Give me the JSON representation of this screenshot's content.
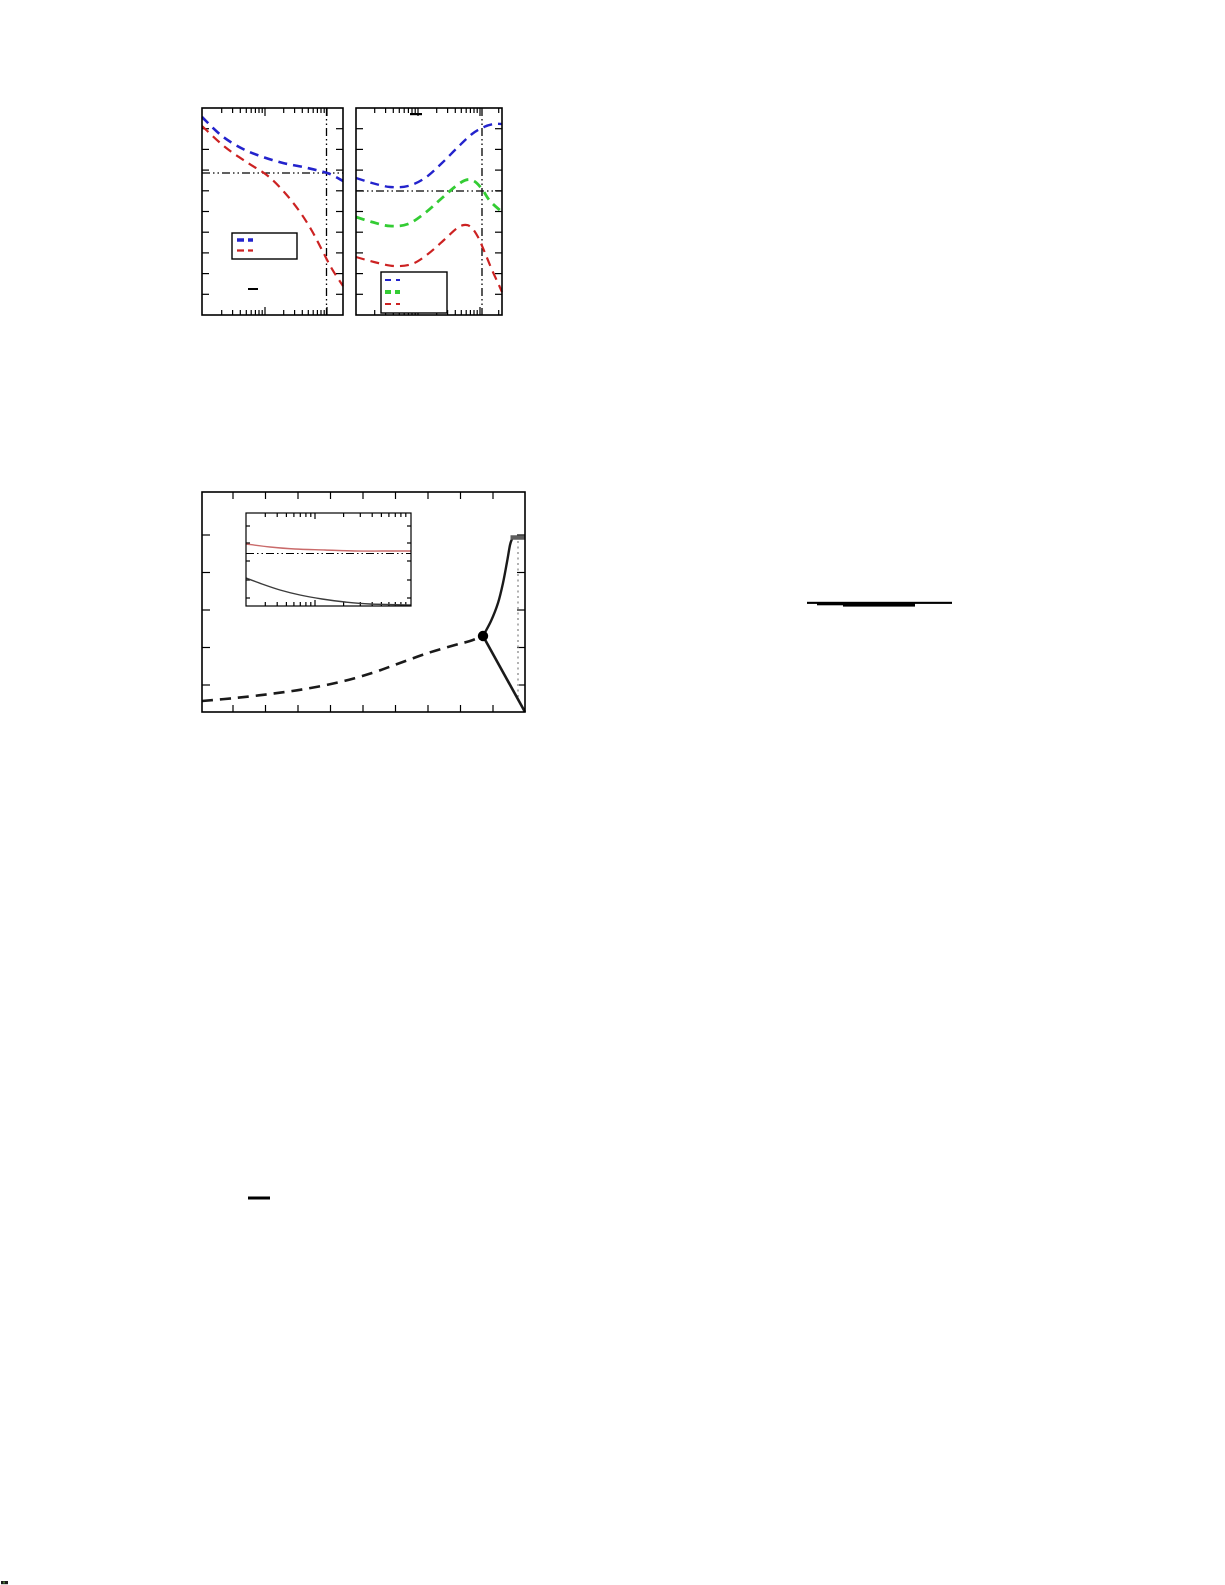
{
  "canvas": {
    "width": 1225,
    "height": 1585,
    "background": "#ffffff"
  },
  "colors": {
    "blue": "#2323cc",
    "red": "#cc2222",
    "green": "#33cc33",
    "black": "#000000",
    "near_black": "#1a1a1a",
    "gray": "#b2b2b2",
    "plateau": "#5e5e5e",
    "inset_red": "#c96a6a",
    "inset_black": "#3c3c3c"
  },
  "chart_data": [
    {
      "id": "top-left",
      "type": "line",
      "title": "",
      "xlabel": "",
      "ylabel": "",
      "x_scale": "log",
      "y_scale": "linear",
      "axis_text_rendered": false,
      "frame": {
        "x": 202,
        "y": 108,
        "w": 141,
        "h": 207
      },
      "ticks": [
        {
          "edge": "bottom",
          "len": 5,
          "pos": [
            221.7,
            232.6,
            240.3,
            246.3,
            251.2,
            255.4,
            259,
            262.2,
            283.7,
            294.6,
            302.3,
            308.3,
            313.2,
            317.4,
            321,
            324.2
          ]
        },
        {
          "edge": "bottom",
          "len": 8,
          "pos": [
            265,
            327
          ]
        },
        {
          "edge": "top",
          "len": 5,
          "pos": [
            221.7,
            232.6,
            240.3,
            246.3,
            251.2,
            255.4,
            259,
            262.2,
            283.7,
            294.6,
            302.3,
            308.3,
            313.2,
            317.4,
            321,
            324.2
          ]
        },
        {
          "edge": "top",
          "len": 8,
          "pos": [
            265,
            327
          ]
        },
        {
          "edge": "left",
          "len": 7,
          "pos": [
            128.7,
            149.4,
            170.1,
            190.8,
            211.5,
            232.2,
            252.9,
            273.6,
            294.3
          ]
        },
        {
          "edge": "right",
          "len": 7,
          "pos": [
            128.7,
            149.4,
            170.1,
            190.8,
            211.5,
            232.2,
            252.9,
            273.6,
            294.3
          ]
        }
      ],
      "ref_lines": [
        {
          "orient": "h",
          "at": 173,
          "from": 202,
          "to": 343,
          "style": "dashdotdot",
          "color": "black",
          "w": 1.3
        },
        {
          "orient": "v",
          "at": 326.5,
          "from": 108,
          "to": 315,
          "style": "dashdotdot",
          "color": "black",
          "w": 1.3
        }
      ],
      "series": [
        {
          "name": "blue-dashed",
          "color": "blue",
          "w": 2.6,
          "dash": "9 6",
          "smooth": true,
          "pts": [
            [
              202,
              117
            ],
            [
              222,
              136
            ],
            [
              243,
              149
            ],
            [
              263,
              157
            ],
            [
              283,
              163
            ],
            [
              303,
              167
            ],
            [
              320,
              171
            ],
            [
              330,
              174
            ],
            [
              343,
              181
            ]
          ]
        },
        {
          "name": "red-dashed",
          "color": "red",
          "w": 2.2,
          "dash": "9 6",
          "smooth": true,
          "pts": [
            [
              202,
              126
            ],
            [
              225,
              147
            ],
            [
              248,
              163
            ],
            [
              268,
              176
            ],
            [
              285,
              193
            ],
            [
              300,
              212
            ],
            [
              312,
              231
            ],
            [
              322,
              250
            ],
            [
              332,
              269
            ],
            [
              343,
              286
            ]
          ]
        }
      ],
      "legend": {
        "box": {
          "x": 232,
          "y": 233,
          "w": 65,
          "h": 26
        },
        "sample_x1": 237,
        "sample_x2": 253,
        "entries": [
          {
            "label": "",
            "color": "blue",
            "w": 3.6,
            "dash": "7 4",
            "y": 240
          },
          {
            "label": "",
            "color": "red",
            "w": 2.2,
            "dash": "7 4",
            "y": 250.5
          }
        ]
      },
      "marks": [
        {
          "type": "bar",
          "x": 248,
          "y": 288,
          "w": 10,
          "h": 2,
          "color": "black"
        }
      ]
    },
    {
      "id": "top-right",
      "type": "line",
      "title": "",
      "xlabel": "",
      "ylabel": "",
      "x_scale": "log",
      "y_scale": "linear",
      "axis_text_rendered": false,
      "frame": {
        "x": 356,
        "y": 108,
        "w": 146,
        "h": 207
      },
      "ticks": [
        {
          "edge": "bottom",
          "len": 5,
          "pos": [
            374.7,
            385.6,
            393.3,
            399.3,
            404.2,
            408.4,
            412,
            415.2,
            436.7,
            447.6,
            455.3,
            461.3,
            466.2,
            470.4,
            474,
            477.2,
            498.7
          ]
        },
        {
          "edge": "bottom",
          "len": 8,
          "pos": [
            418,
            480
          ]
        },
        {
          "edge": "top",
          "len": 5,
          "pos": [
            374.7,
            385.6,
            393.3,
            399.3,
            404.2,
            408.4,
            412,
            415.2,
            436.7,
            447.6,
            455.3,
            461.3,
            466.2,
            470.4,
            474,
            477.2,
            498.7
          ]
        },
        {
          "edge": "top",
          "len": 8,
          "pos": [
            418,
            480
          ]
        },
        {
          "edge": "left",
          "len": 7,
          "pos": [
            128.7,
            149.4,
            170.1,
            190.8,
            211.5,
            232.2,
            252.9,
            273.6,
            294.3
          ]
        },
        {
          "edge": "right",
          "len": 7,
          "pos": [
            128.7,
            149.4,
            170.1,
            190.8,
            211.5,
            232.2,
            252.9,
            273.6,
            294.3
          ]
        }
      ],
      "ref_lines": [
        {
          "orient": "h",
          "at": 191,
          "from": 356,
          "to": 502,
          "style": "dashdotdot",
          "color": "black",
          "w": 1.3
        },
        {
          "orient": "v",
          "at": 482,
          "from": 108,
          "to": 315,
          "style": "dashdotdot",
          "color": "black",
          "w": 1.3
        }
      ],
      "series": [
        {
          "name": "blue-dashed",
          "color": "blue",
          "w": 2.4,
          "dash": "9 6",
          "smooth": true,
          "pts": [
            [
              356,
              178
            ],
            [
              372,
              183
            ],
            [
              390,
              187
            ],
            [
              408,
              186
            ],
            [
              425,
              178
            ],
            [
              442,
              163
            ],
            [
              458,
              147
            ],
            [
              472,
              134
            ],
            [
              484,
              127
            ],
            [
              494,
              124
            ],
            [
              502,
              124
            ]
          ]
        },
        {
          "name": "green-dashed",
          "color": "green",
          "w": 2.8,
          "dash": "9 6",
          "smooth": true,
          "pts": [
            [
              356,
              217
            ],
            [
              372,
              222
            ],
            [
              390,
              226
            ],
            [
              408,
              224
            ],
            [
              425,
              213
            ],
            [
              442,
              198
            ],
            [
              456,
              186
            ],
            [
              466,
              180
            ],
            [
              474,
              181
            ],
            [
              482,
              189
            ],
            [
              490,
              201
            ],
            [
              502,
              212
            ]
          ]
        },
        {
          "name": "red-dashed",
          "color": "red",
          "w": 2.2,
          "dash": "9 6",
          "smooth": true,
          "pts": [
            [
              356,
              257
            ],
            [
              374,
              262
            ],
            [
              394,
              266
            ],
            [
              412,
              264
            ],
            [
              428,
              254
            ],
            [
              444,
              240
            ],
            [
              456,
              229
            ],
            [
              464,
              225
            ],
            [
              471,
              227
            ],
            [
              478,
              237
            ],
            [
              485,
              253
            ],
            [
              492,
              270
            ],
            [
              498,
              283
            ],
            [
              502,
              292
            ]
          ]
        }
      ],
      "legend": {
        "box": {
          "x": 381,
          "y": 272,
          "w": 66,
          "h": 41
        },
        "sample_x1": 385,
        "sample_x2": 400,
        "entries": [
          {
            "label": "",
            "color": "blue",
            "w": 2.0,
            "dash": "6 5",
            "y": 280
          },
          {
            "label": "",
            "color": "green",
            "w": 4.0,
            "dash": "6 4",
            "y": 292
          },
          {
            "label": "",
            "color": "red",
            "w": 2.0,
            "dash": "6 5",
            "y": 304
          }
        ]
      },
      "marks": [
        {
          "type": "bar",
          "x": 410,
          "y": 113,
          "w": 12,
          "h": 2.2,
          "color": "black"
        }
      ]
    },
    {
      "id": "main",
      "type": "line",
      "title": "",
      "xlabel": "",
      "ylabel": "",
      "x_scale": "linear",
      "y_scale": "linear",
      "axis_text_rendered": false,
      "frame": {
        "x": 202,
        "y": 492,
        "w": 323,
        "h": 220
      },
      "ticks": [
        {
          "edge": "bottom",
          "len": 7,
          "pos": [
            233,
            265.5,
            298,
            330.5,
            363,
            395.5,
            428,
            460.5,
            493
          ]
        },
        {
          "edge": "top",
          "len": 7,
          "pos": [
            233,
            265.5,
            298,
            330.5,
            363,
            395.5,
            428,
            460.5,
            493
          ]
        },
        {
          "edge": "left",
          "len": 8,
          "pos": [
            535,
            572.5,
            610,
            647.5,
            685
          ]
        },
        {
          "edge": "right",
          "len": 8,
          "pos": [
            535,
            572.5,
            610,
            647.5,
            685
          ]
        }
      ],
      "ref_lines": [
        {
          "orient": "v",
          "at": 518,
          "from": 541,
          "to": 700,
          "style": "dotted",
          "color": "gray",
          "w": 2
        }
      ],
      "series": [
        {
          "name": "lower-branch-dashed",
          "color": "near_black",
          "w": 2.6,
          "dash": "11 7",
          "smooth": true,
          "pts": [
            [
              202,
              701
            ],
            [
              235,
              698
            ],
            [
              270,
              694
            ],
            [
              305,
              689
            ],
            [
              340,
              682
            ],
            [
              372,
              673
            ],
            [
              400,
              663
            ],
            [
              428,
              653
            ],
            [
              455,
              645
            ],
            [
              470,
              641
            ],
            [
              483,
              636
            ]
          ]
        },
        {
          "name": "upper-branch-solid",
          "color": "near_black",
          "w": 2.4,
          "smooth": true,
          "pts": [
            [
              483,
              636
            ],
            [
              491,
              621
            ],
            [
              498,
              603
            ],
            [
              503,
              583
            ],
            [
              507,
              562
            ],
            [
              510,
              545
            ],
            [
              512,
              539
            ]
          ]
        },
        {
          "name": "plateau-segment",
          "color": "plateau",
          "w": 4.5,
          "pts": [
            [
              510.5,
              537.5
            ],
            [
              525,
              537.5
            ]
          ]
        },
        {
          "name": "descending-branch-solid",
          "color": "near_black",
          "w": 2.6,
          "pts": [
            [
              483,
              636
            ],
            [
              525,
              712
            ]
          ]
        }
      ],
      "marks": [
        {
          "type": "dot",
          "cx": 483,
          "cy": 636,
          "r": 5.2
        }
      ],
      "children": [
        {
          "id": "main-inset",
          "type": "line",
          "x_scale": "log",
          "y_scale": "linear",
          "axis_text_rendered": false,
          "frame": {
            "x": 246,
            "y": 513,
            "w": 165,
            "h": 93
          },
          "frame_w": 1.2,
          "ticks": [
            {
              "edge": "bottom",
              "len": 4,
              "pos": [
                265.3,
                277.2,
                286.4,
                293.9,
                300.3,
                305.9,
                310.8,
                343.6,
                360.3,
                372.2,
                381.4,
                388.9,
                395.3,
                400.9,
                405.8
              ]
            },
            {
              "edge": "bottom",
              "len": 6,
              "pos": [
                315
              ]
            },
            {
              "edge": "top",
              "len": 4,
              "pos": [
                265.3,
                277.2,
                286.4,
                293.9,
                300.3,
                305.9,
                310.8,
                343.6,
                360.3,
                372.2,
                381.4,
                388.9,
                395.3,
                400.9,
                405.8
              ]
            },
            {
              "edge": "top",
              "len": 6,
              "pos": [
                315
              ]
            },
            {
              "edge": "left",
              "len": 4,
              "pos": [
                526,
                543,
                561,
                580,
                598
              ]
            },
            {
              "edge": "right",
              "len": 4,
              "pos": [
                526,
                543,
                561,
                580,
                598
              ]
            }
          ],
          "ref_lines": [
            {
              "orient": "h",
              "at": 553.5,
              "from": 246,
              "to": 411,
              "style": "dashdotdot",
              "color": "black",
              "w": 1.1
            }
          ],
          "series": [
            {
              "name": "inset-red-curve",
              "color": "inset_red",
              "w": 1.4,
              "smooth": true,
              "pts": [
                [
                  246,
                  544
                ],
                [
                  270,
                  547
                ],
                [
                  295,
                  549
                ],
                [
                  325,
                  550
                ],
                [
                  355,
                  551
                ],
                [
                  385,
                  551
                ],
                [
                  411,
                  551
                ]
              ]
            },
            {
              "name": "inset-black-curve",
              "color": "inset_black",
              "w": 1.4,
              "smooth": true,
              "pts": [
                [
                  246,
                  578
                ],
                [
                  262,
                  584
                ],
                [
                  280,
                  590
                ],
                [
                  300,
                  595
                ],
                [
                  322,
                  599
                ],
                [
                  345,
                  602
                ],
                [
                  370,
                  604
                ],
                [
                  411,
                  605
                ]
              ]
            }
          ]
        }
      ]
    }
  ],
  "fragments": [
    {
      "name": "equation-fraction-bar-large",
      "rects": [
        [
          807,
          601.8,
          145,
          2.1
        ],
        [
          817,
          603.4,
          26,
          1.9
        ],
        [
          843,
          603,
          72,
          3.6
        ]
      ]
    },
    {
      "name": "equation-fraction-bar-small",
      "rects": [
        [
          248,
          1196.5,
          22,
          3
        ]
      ]
    }
  ],
  "corner_mark": [
    [
      1,
      1581,
      7,
      3.2,
      "#1c1c1c"
    ],
    [
      3,
      1581.5,
      2,
      2,
      "#4a7a3a"
    ]
  ]
}
